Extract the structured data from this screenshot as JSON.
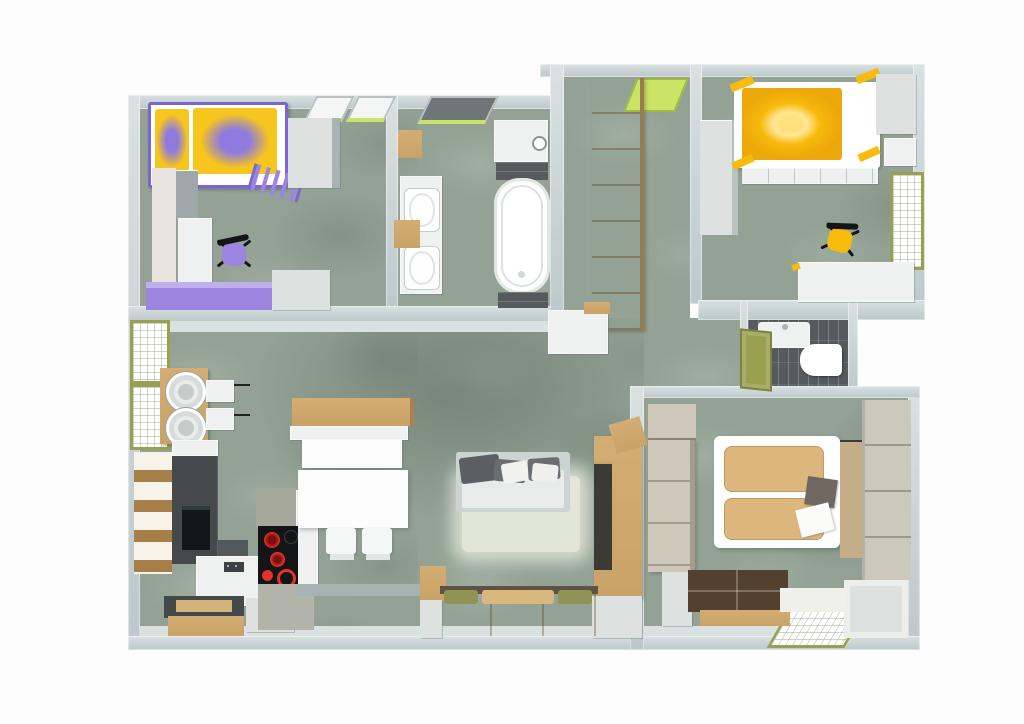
{
  "app": {
    "type": "3d-floor-plan-top-down-render",
    "visible_text": "",
    "background": "#ffffff"
  },
  "palette": {
    "floor": "#93a295",
    "wall": "#bcc8cb",
    "wallFace": "#d9e1e1",
    "wood": "#c9a267",
    "woodDark": "#8a6c44",
    "woodPale": "#cdc8ba",
    "purple": "#9c85e0",
    "purpleDeep": "#7b64d4",
    "yellow": "#f7bb0b",
    "yellowLight": "#ffd96a",
    "olive": "#99a050",
    "lime": "#cbe466",
    "anthracite": "#45494c",
    "tileDark": "#565a5d",
    "tan": "#ddb67e",
    "brown": "#54402e",
    "red": "#e2322a",
    "offWhite": "#eef1f0",
    "grayBox": "#dde2e0",
    "concrete": "#b2b4a9",
    "rug": "#e9ecdd",
    "slate": "#6f6862"
  },
  "rooms": [
    {
      "name": "kids-bedroom-purple",
      "accent": "#9c85e0",
      "furniture": [
        "loft-bed-purple-yellow-duvet",
        "ladder",
        "wardrobe",
        "desk",
        "swivel-chair-purple",
        "dresser-purple",
        "skylight-windows"
      ]
    },
    {
      "name": "bathroom",
      "furniture": [
        "double-washbasin",
        "bathtub",
        "shower",
        "dark-tile-strips",
        "skylight-window",
        "wood-shelf"
      ]
    },
    {
      "name": "entry-hall",
      "furniture": [
        "tall-wood-wardrobe",
        "entrance-door-lime"
      ]
    },
    {
      "name": "kids-bedroom-yellow",
      "accent": "#f7bb0b",
      "furniture": [
        "bed-yellow-duvet",
        "shelf-steps",
        "corner-wardrobe",
        "window",
        "desk",
        "swivel-chair-yellow"
      ]
    },
    {
      "name": "wc",
      "furniture": [
        "washbasin",
        "toilet",
        "dark-floor-tiles",
        "door-olive"
      ]
    },
    {
      "name": "master-bedroom",
      "accent": "#ddb67e",
      "furniture": [
        "double-bed-tan-duvets",
        "wardrobe-left",
        "wardrobe-right",
        "dresser",
        "dark-chest",
        "floor-window"
      ]
    },
    {
      "name": "living-kitchen",
      "furniture": [
        "washer-dryer-tower",
        "wall-shelves",
        "open-shelf-unit",
        "tall-kitchen-unit-with-oven",
        "kitchen-island-induction-hob",
        "dining-bench",
        "dining-table",
        "two-chairs",
        "sofa-gray",
        "rug-white",
        "bookcase-wood",
        "window-benches-olive-cushions",
        "side-windows"
      ]
    }
  ]
}
